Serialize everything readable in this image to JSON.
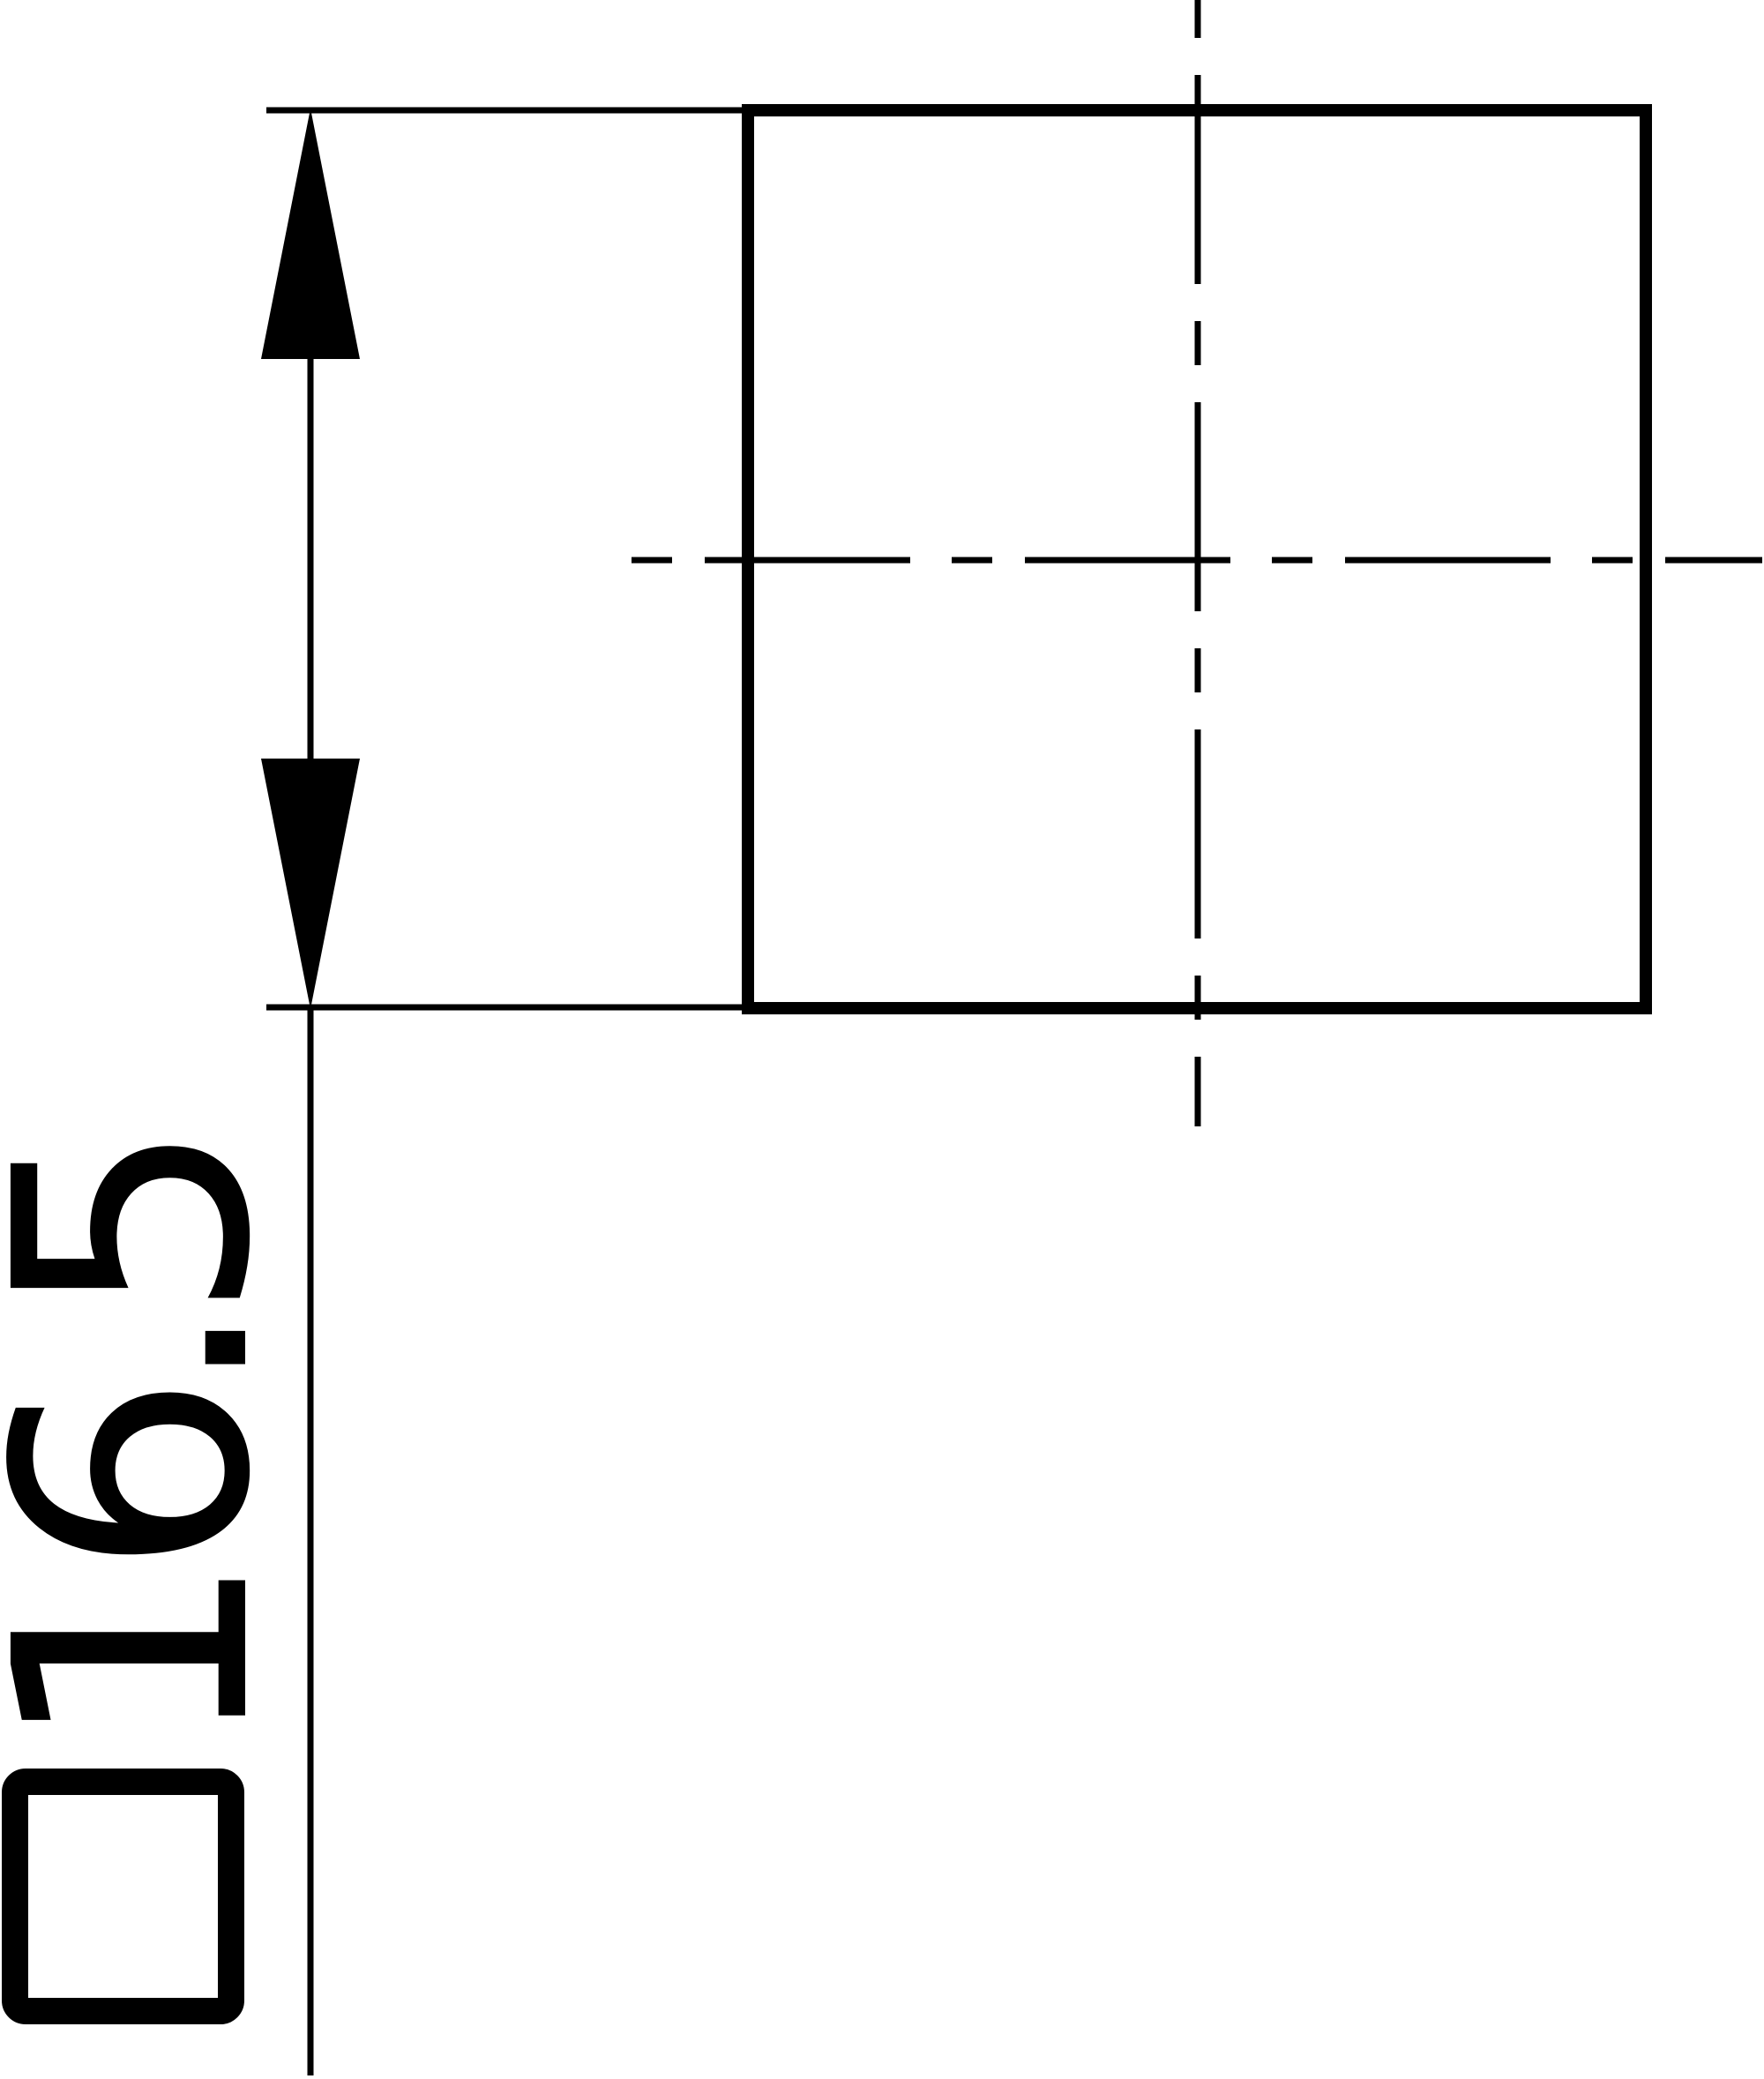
{
  "drawing": {
    "view": {
      "shape": "square-profile",
      "centerlines": "dash-dot"
    },
    "dimension": {
      "label": "□16.5",
      "symbol": "□",
      "value": "16.5",
      "orientation": "rotated-90-ccw"
    },
    "colors": {
      "ink": "#000000",
      "paper": "#ffffff"
    }
  }
}
